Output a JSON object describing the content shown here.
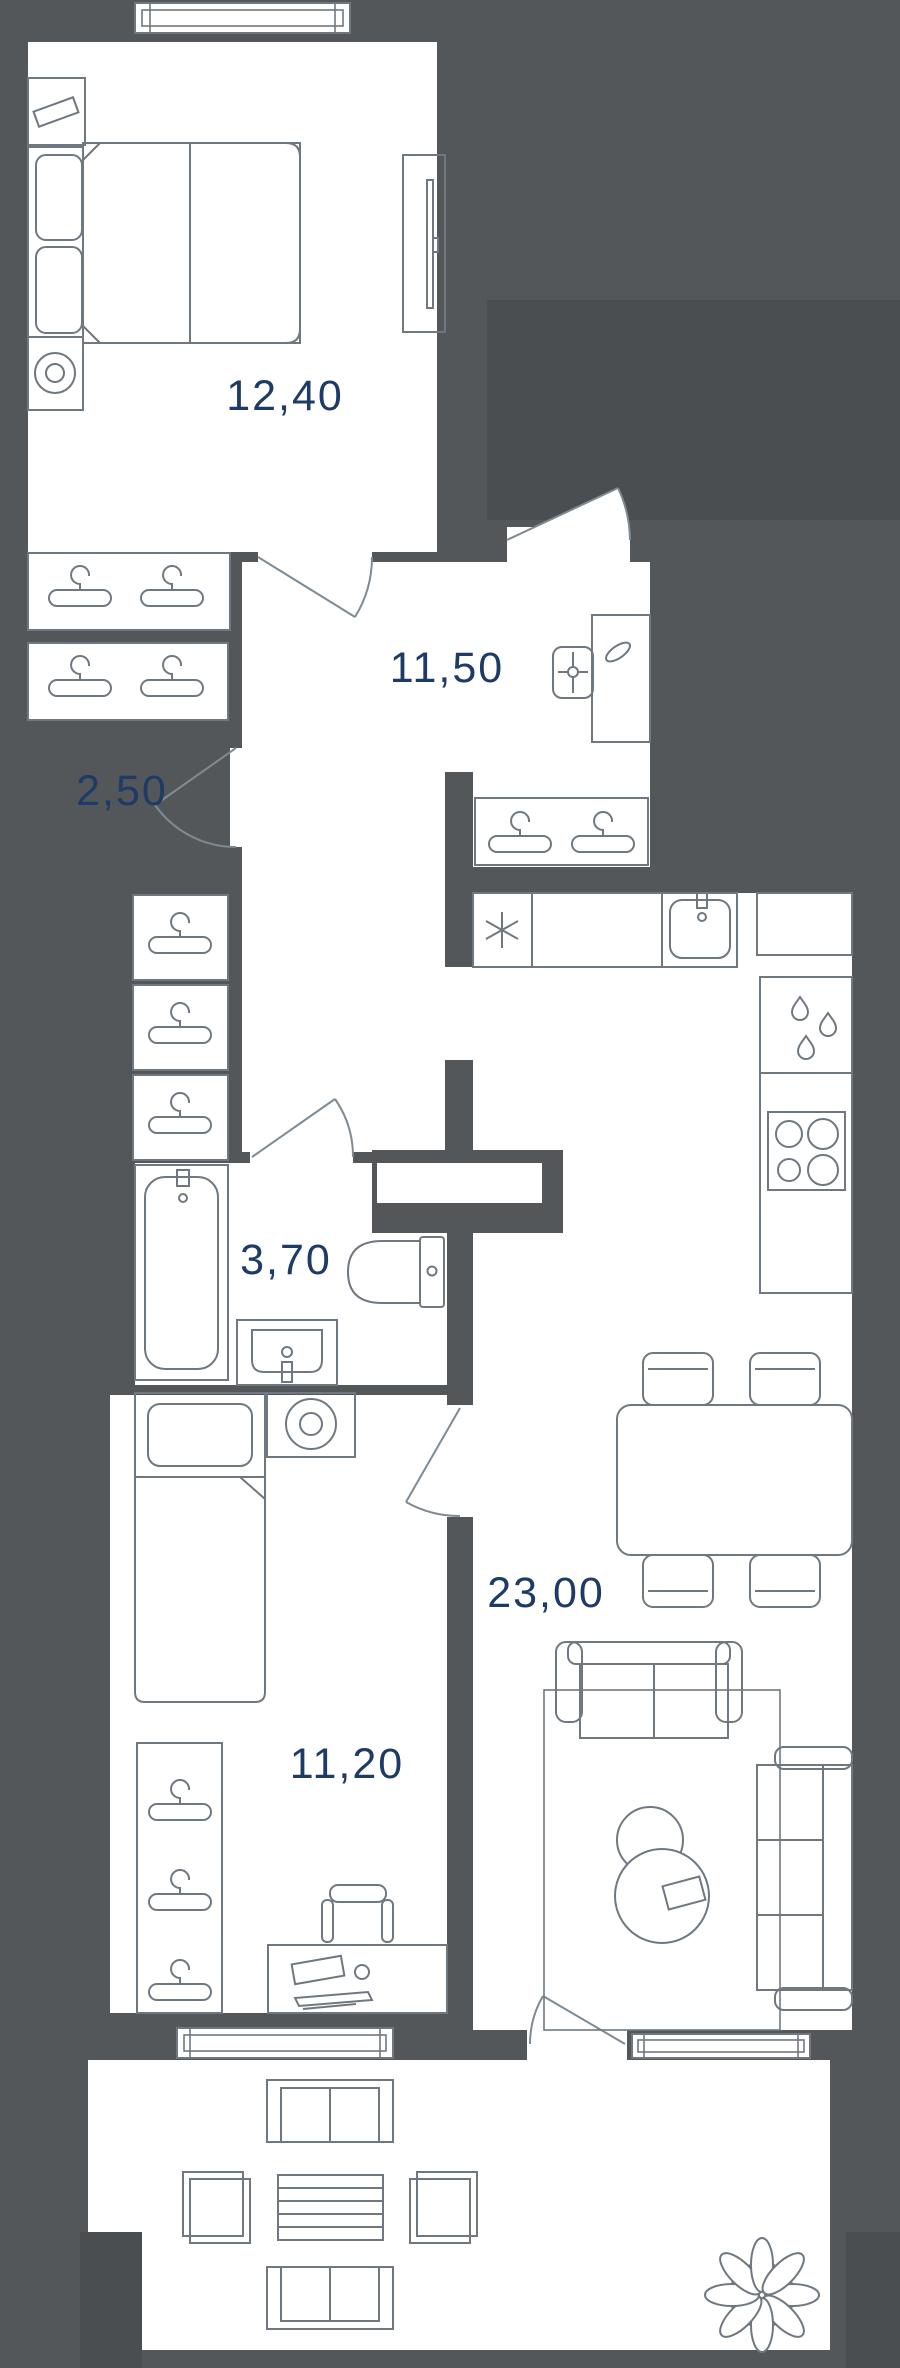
{
  "title": "apartment-floor-plan",
  "colors": {
    "background": "#54575A",
    "wall": "#54575A",
    "pier": "#4B4E51",
    "room": "#FFFFFF",
    "line": "#6F7881",
    "door": "#7E8A94",
    "label": "#1D3B66"
  },
  "rooms": [
    {
      "id": "bedroom",
      "area_label": "12,40"
    },
    {
      "id": "hallway",
      "area_label": "11,50"
    },
    {
      "id": "wardrobe",
      "area_label": "2,50"
    },
    {
      "id": "bathroom",
      "area_label": "3,70"
    },
    {
      "id": "kitchen-living-room",
      "area_label": "23,00"
    },
    {
      "id": "bedroom-2",
      "area_label": "11,20"
    }
  ],
  "furniture": {
    "bedroom": [
      "nightstand",
      "table-lamp",
      "double-bed",
      "pillows",
      "blanket",
      "bedside-table",
      "round-lamp",
      "tv-console"
    ],
    "hallway": [
      "coat-hangers",
      "desk",
      "office-chair",
      "entrance-door"
    ],
    "wardrobe": [
      "clothes-hangers"
    ],
    "corridor": [
      "clothes-hangers"
    ],
    "kitchen": [
      "refrigerator",
      "counter",
      "sink",
      "dishwasher",
      "stove",
      "dining-table",
      "chairs"
    ],
    "living": [
      "rug",
      "loveseat",
      "sofa",
      "coffee-tables",
      "book"
    ],
    "bathroom": [
      "bathtub",
      "toilet",
      "washbasin"
    ],
    "bedroom-2": [
      "single-bed",
      "washing-machine",
      "wardrobe-hangers",
      "desk",
      "office-chair"
    ],
    "balcony": [
      "bench",
      "slat-table",
      "stools",
      "plant"
    ]
  },
  "windows": 3,
  "doors": 7
}
